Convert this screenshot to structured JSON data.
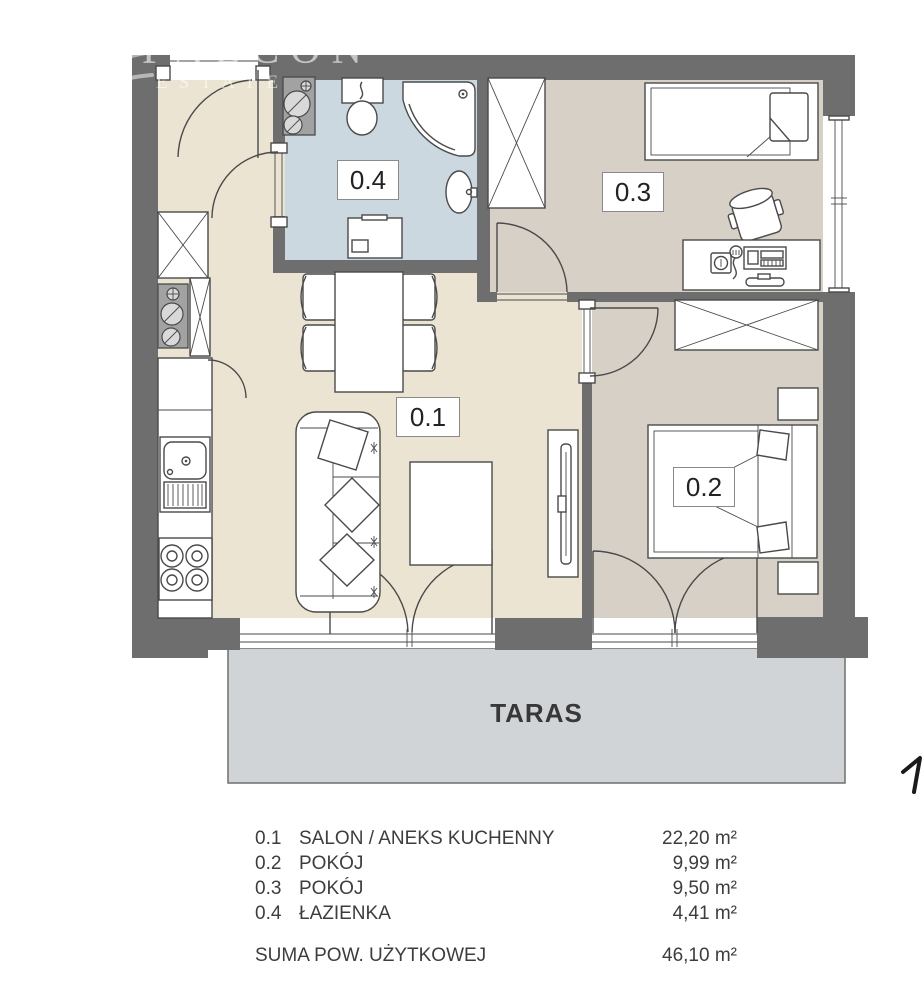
{
  "watermark": {
    "line1": "FALCON",
    "line2": "ESTATE"
  },
  "plan": {
    "terrace_label": "TARAS",
    "rooms": [
      {
        "id": "0.1",
        "name": "SALON / ANEKS KUCHENNY",
        "area": "22,20 m²"
      },
      {
        "id": "0.2",
        "name": "POKÓJ",
        "area": "9,99 m²"
      },
      {
        "id": "0.3",
        "name": "POKÓJ",
        "area": "9,50 m²"
      },
      {
        "id": "0.4",
        "name": "ŁAZIENKA",
        "area": "4,41 m²"
      }
    ]
  },
  "legend": {
    "total_label": "SUMA POW. UŻYTKOWEJ",
    "total_area": "46,10 m²"
  },
  "colors": {
    "wall": "#6e6e6e",
    "line": "#4a4a4a",
    "floor-main": "#ebe4d3",
    "floor-room": "#d7d0c7",
    "floor-bath": "#cbd8e0",
    "floor-terrace": "#d0d4d6",
    "text": "#3d3d3d"
  }
}
